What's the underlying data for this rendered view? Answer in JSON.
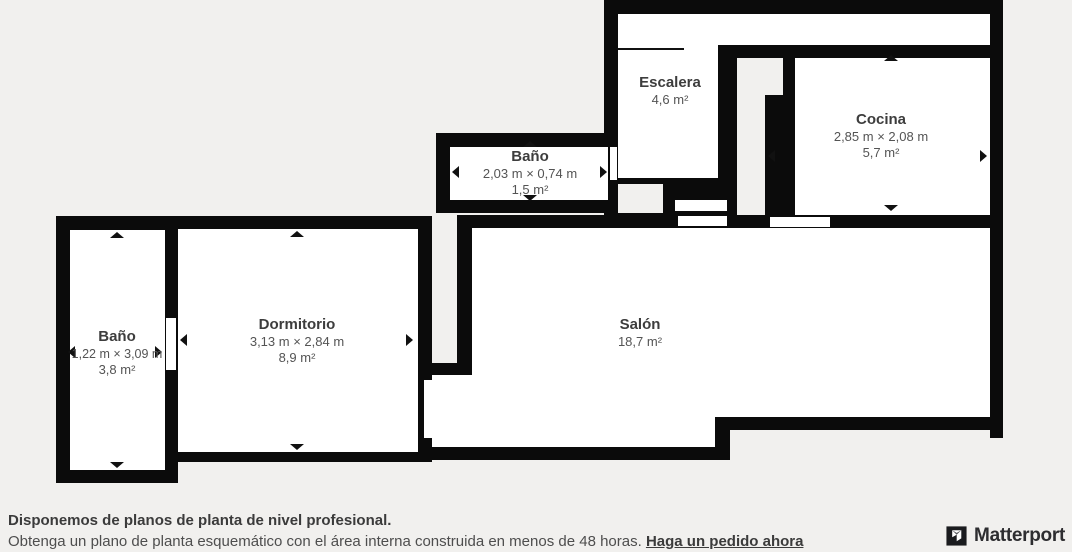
{
  "plan": {
    "rooms": [
      {
        "id": "escalera",
        "name": "Escalera",
        "dims": "",
        "area": "4,6 m²"
      },
      {
        "id": "bano-top",
        "name": "Baño",
        "dims": "2,03 m × 0,74 m",
        "area": "1,5 m²"
      },
      {
        "id": "cocina",
        "name": "Cocina",
        "dims": "2,85 m × 2,08 m",
        "area": "5,7 m²"
      },
      {
        "id": "bano-left",
        "name": "Baño",
        "dims": "1,22 m × 3,09 m",
        "area": "3,8 m²"
      },
      {
        "id": "dormitorio",
        "name": "Dormitorio",
        "dims": "3,13 m × 2,84 m",
        "area": "8,9 m²"
      },
      {
        "id": "salon",
        "name": "Salón",
        "dims": "",
        "area": "18,7 m²"
      }
    ]
  },
  "footer": {
    "headline": "Disponemos de planos de planta de nivel profesional.",
    "body": "Obtenga un plano de planta esquemático con el área interna construida en menos de 48 horas. ",
    "link_label": "Haga un pedido ahora"
  },
  "branding": {
    "logo_text": "Matterport",
    "logo_icon": "matterport-cube-icon"
  },
  "colors": {
    "wall": "#0b0b0b",
    "room": "#ffffff",
    "background": "#f1f0ee",
    "label_text": "#3d3d3d",
    "dim_text": "#545454"
  }
}
